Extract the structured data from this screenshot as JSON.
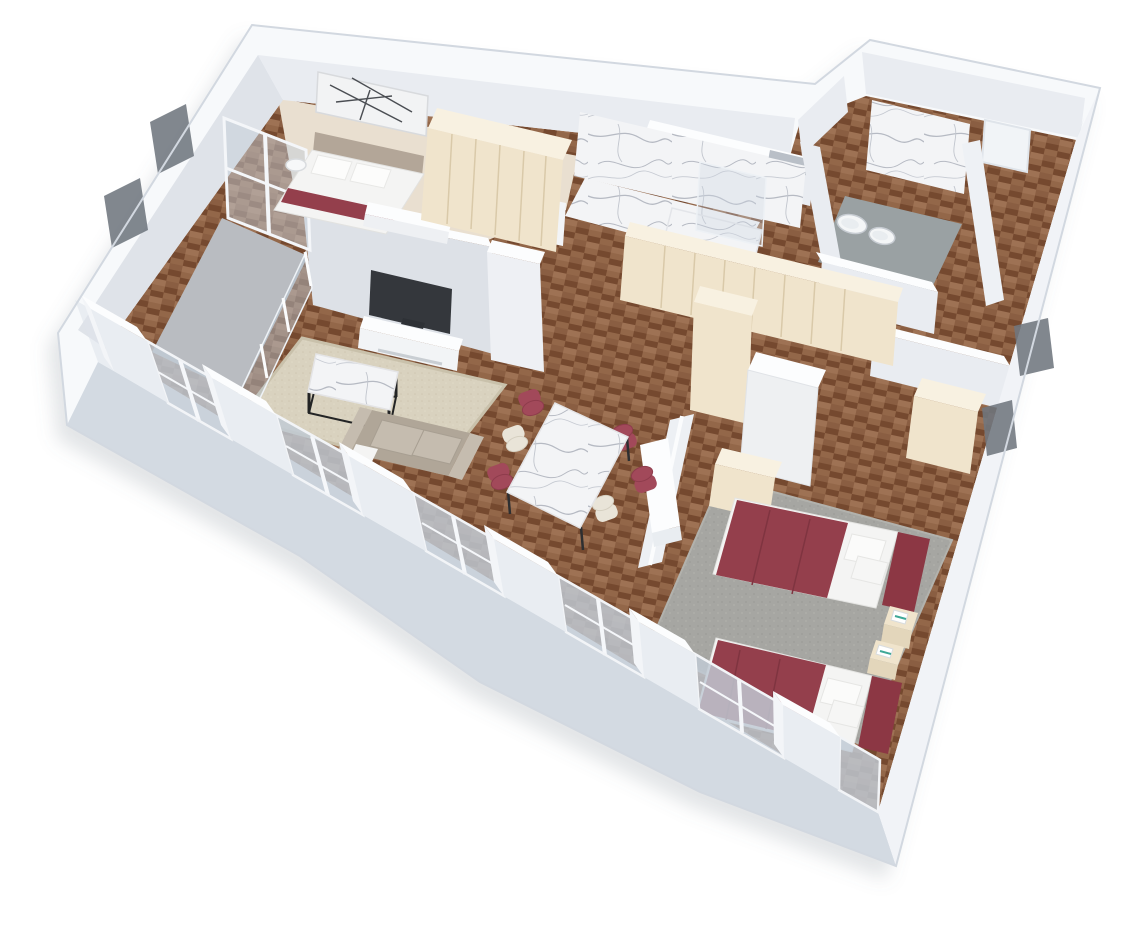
{
  "scene": {
    "description": "3D isometric cutaway floor plan render of a two-bedroom apartment on a white background",
    "projection": "isometric cutaway, walls cut at top, viewed from above south-west",
    "background": "#ffffff",
    "visible_text": "none"
  },
  "palette": {
    "bg": "#ffffff",
    "wallTop": "#f7f9fb",
    "wallFace": "#e9ecf1",
    "wallFaceDim": "#dfe3e9",
    "tvWall": "#dde1e7",
    "white": "#fcfdfe",
    "outline": "#d2d8e0",
    "facade": "#dfe4eb",
    "slab": "#d3dae2",
    "pierFace": "#e9edf2",
    "pierSide": "#f3f5f8",
    "glass": "#b7c2cd",
    "darkWindow": "#6f767e",
    "wood": "#8a5e42",
    "woodDark": "#75492f",
    "woodMid": "#936749",
    "woodLight": "#9e7254",
    "paleFloor": "#e9dfd0",
    "balconyFloor": "#b9bcc1",
    "bathFloor": "#9aa1a3",
    "marble": "#f3f4f6",
    "marbleVein": "#b6bac3",
    "carpet": "#a6a6a2",
    "rug": "#d9d2bf",
    "rugLine": "#c9c1ab",
    "cream": "#f0e4cc",
    "creamTop": "#f8f1e1",
    "creamLine": "#d9c9a9",
    "red": "#943f4c",
    "redFold": "#7f3440",
    "headboard": "#8c3744",
    "chairRed": "#a2495a",
    "chairCream": "#e9e4d8",
    "sofa": "#b0a698",
    "sofaLight": "#c5bcaf",
    "linen": "#f4f4f3",
    "tv": "#34373c",
    "teal": "#3fa897",
    "shadow": "rgba(108,118,134,0.20)"
  },
  "rooms": [
    {
      "id": "bedroom-1",
      "area": "top-left",
      "floor": "pale wood",
      "furniture": [
        "double bed with white linen and burgundy throw",
        "taupe upholstered headboard",
        "black-and-white abstract wall art",
        "round side table left",
        "round side table right",
        "cream wardrobe with panel doors",
        "white foot-of-bed bench"
      ]
    },
    {
      "id": "balcony",
      "area": "left",
      "floor": "grey",
      "features": [
        "glass balustrade with white posts",
        "window wall to bedroom"
      ]
    },
    {
      "id": "living-room",
      "area": "centre-left",
      "floor": "herringbone parquet",
      "furniture": [
        "flat-screen TV",
        "white media console",
        "beige area rug",
        "marble coffee table with black metal frame",
        "taupe three-seat sofa with white throw"
      ]
    },
    {
      "id": "dining-area",
      "area": "centre",
      "floor": "herringbone parquet",
      "furniture": [
        "white marble dining table",
        "burgundy dining chairs x4",
        "cream dining chairs x2",
        "white sideboard bench"
      ]
    },
    {
      "id": "hallway",
      "area": "centre",
      "floor": "herringbone parquet",
      "furniture": [
        "floor-to-ceiling cream wardrobe wall",
        "tall cream cabinet",
        "white pillar"
      ]
    },
    {
      "id": "shower-bathroom",
      "area": "top-centre",
      "floor": "marble",
      "features": [
        "carrara marble walls",
        "marble bench",
        "glass shower screen",
        "white service shaft box"
      ]
    },
    {
      "id": "wc-bathroom",
      "area": "top-right",
      "floor": "grey tile",
      "features": [
        "marble feature wall",
        "wall-hung toilet",
        "wall-hung bidet"
      ]
    },
    {
      "id": "entry-hall",
      "area": "right-wing",
      "floor": "herringbone parquet",
      "features": [
        "white entry door"
      ]
    },
    {
      "id": "bedroom-2",
      "area": "right",
      "floor": "grey carpet with parquet border",
      "furniture": [
        "bed with burgundy cover and white pillows x2",
        "burgundy headboard x2",
        "cream nightstand with white books x2",
        "white wardrobe",
        "cream wardrobe",
        "low cream cabinet"
      ]
    }
  ],
  "structure": {
    "exterior": "white cutaway walls with bright top faces",
    "southwest_facade": {
      "window_bays": 6,
      "piers": 6,
      "glazing": "full-height blue-grey glass with white mullions"
    },
    "right_facade_small_windows": 2,
    "left_wall_windows": 2,
    "base": "grey plinth slab below floor level",
    "drop_shadow": true
  }
}
